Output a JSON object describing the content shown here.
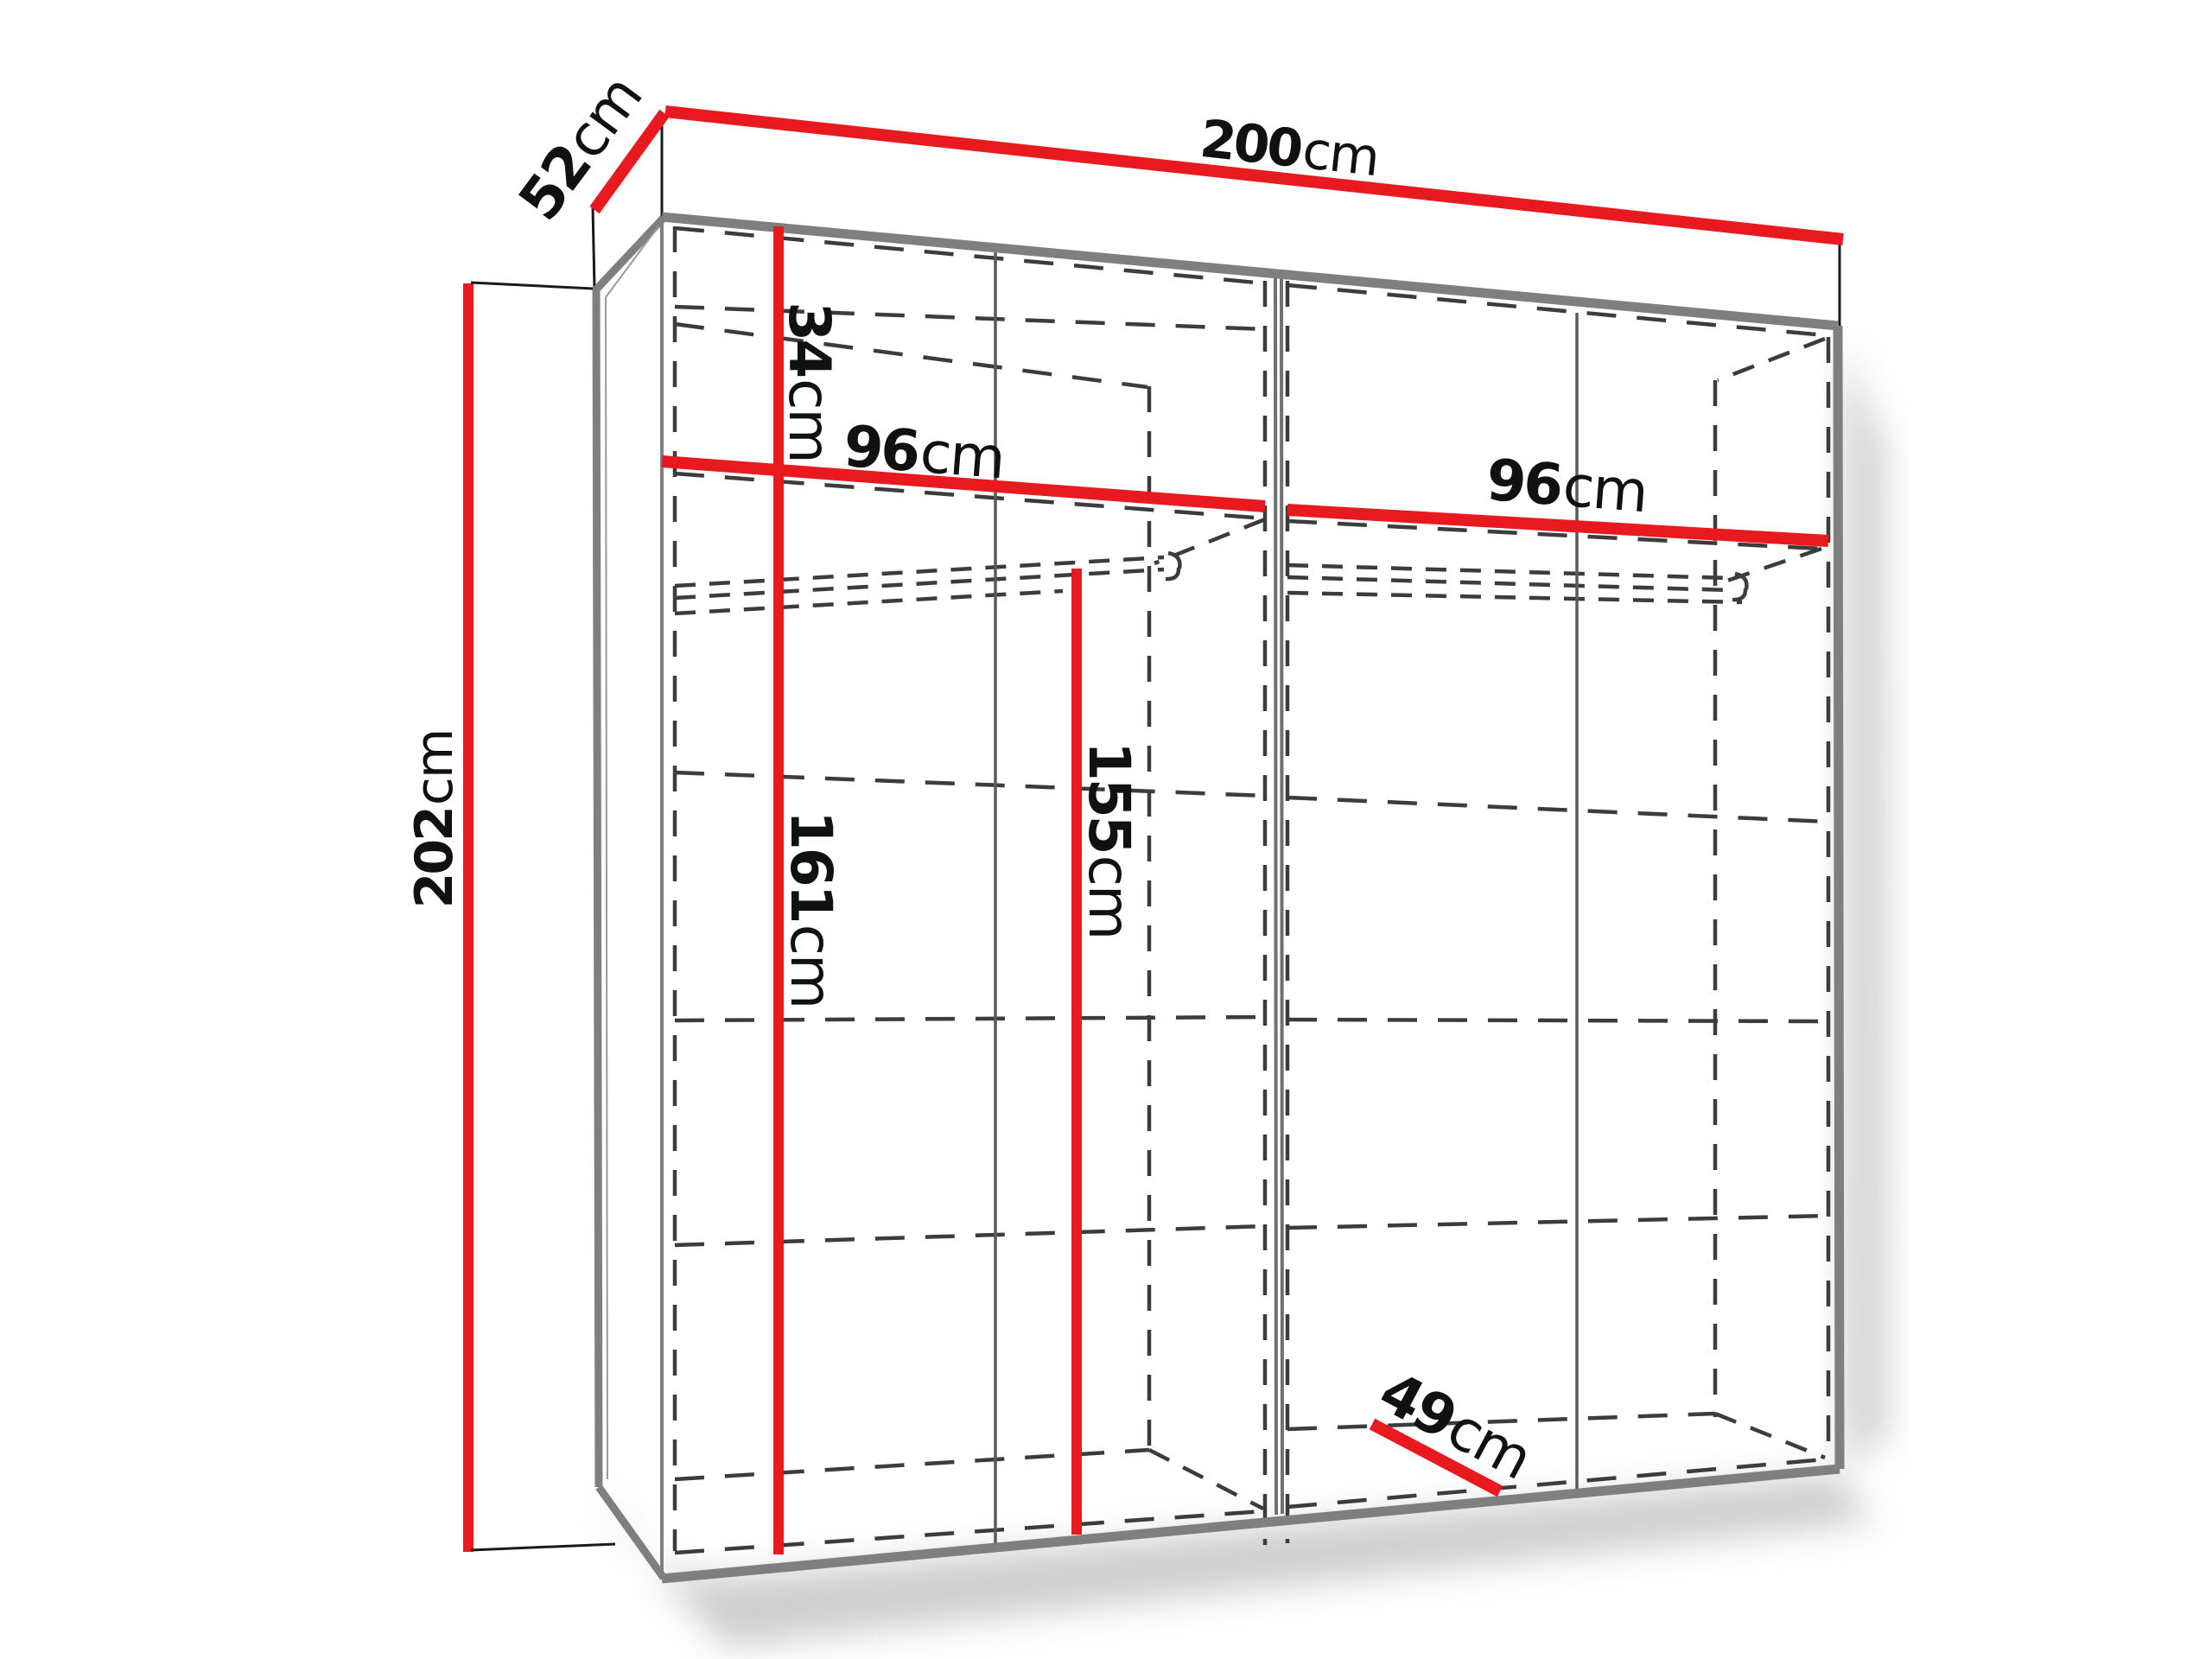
{
  "colors": {
    "dimension_red": "#e8191f",
    "frame_gray": "#7f7f7f",
    "dash_dark": "#3c3c3c",
    "label_black": "#111111"
  },
  "dimensions": {
    "total_width": {
      "value": "200",
      "unit": "cm"
    },
    "total_depth": {
      "value": "52",
      "unit": "cm"
    },
    "total_height": {
      "value": "202",
      "unit": "cm"
    },
    "top_shelf_drop": {
      "value": "34",
      "unit": "cm"
    },
    "left_section_width": {
      "value": "96",
      "unit": "cm"
    },
    "right_section_width": {
      "value": "96",
      "unit": "cm"
    },
    "left_inner_height": {
      "value": "161",
      "unit": "cm"
    },
    "rod_clear_height": {
      "value": "155",
      "unit": "cm"
    },
    "inner_depth": {
      "value": "49",
      "unit": "cm"
    }
  }
}
